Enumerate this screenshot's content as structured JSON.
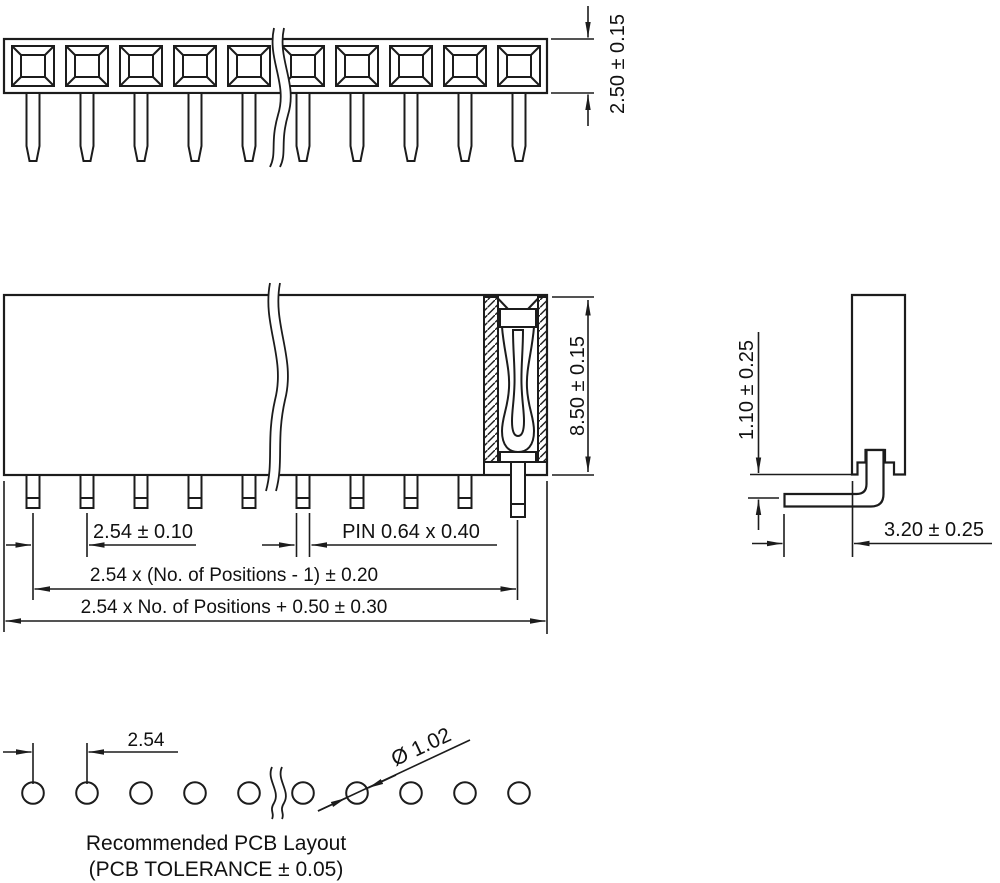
{
  "drawing": {
    "dims": {
      "socket_height": "2.50 ± 0.15",
      "body_height": "8.50 ± 0.15",
      "pin_pitch": "2.54 ± 0.10",
      "pin_size": "PIN 0.64 x 0.40",
      "positions_span": "2.54 x (No. of Positions - 1) ± 0.20",
      "overall_length": "2.54 x No. of Positions + 0.50 ± 0.30",
      "standoff_height": "1.10 ± 0.25",
      "pin_protrusion": "3.20 ± 0.25",
      "hole_pitch": "2.54",
      "hole_diameter": "Ø 1.02"
    },
    "footer": {
      "title": "Recommended PCB Layout",
      "tolerance_note": "(PCB TOLERANCE ± 0.05)"
    },
    "colors": {
      "line": "#1c1c1c",
      "background": "#ffffff"
    }
  }
}
